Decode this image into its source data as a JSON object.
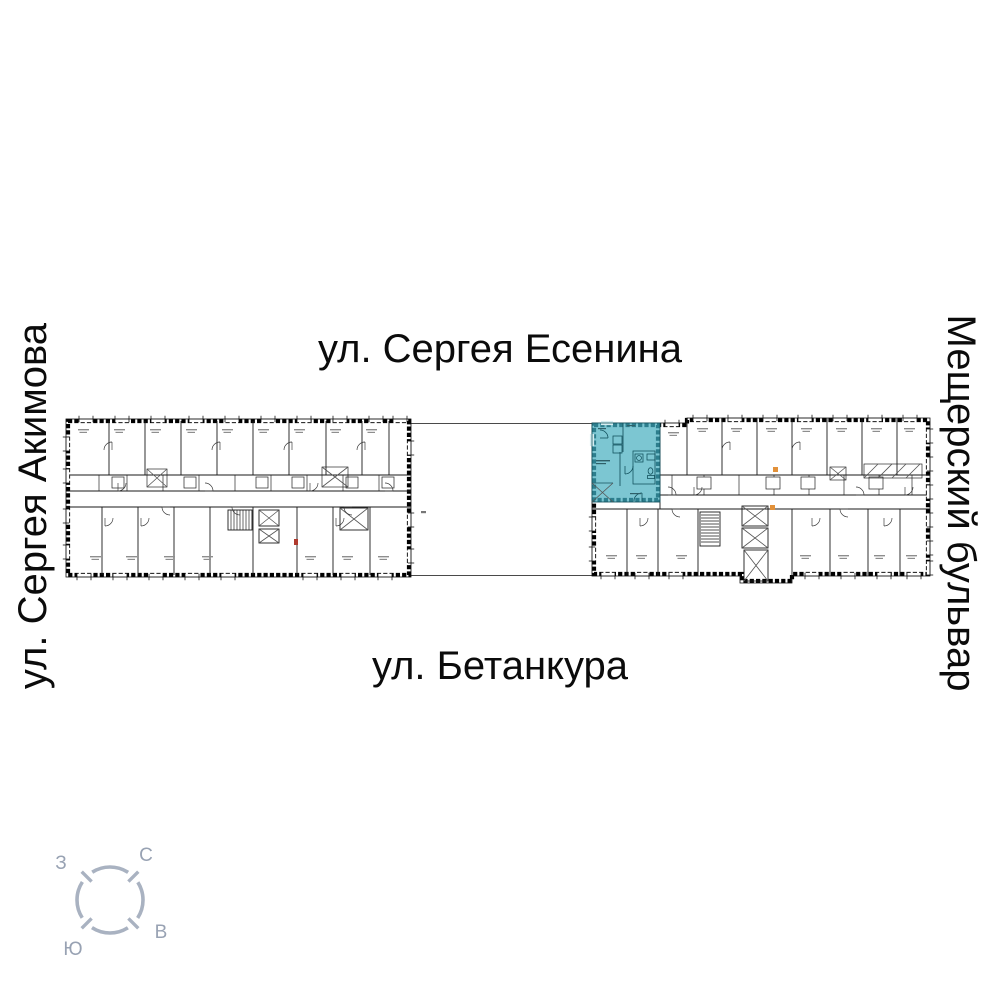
{
  "streets": {
    "top": "ул. Сергея Есенина",
    "bottom": "ул. Бетанкура",
    "left": "ул. Сергея Акимова",
    "right": "Мещерский бульвар"
  },
  "compass": {
    "north": "С",
    "east": "В",
    "south": "Ю",
    "west": "З"
  },
  "colors": {
    "highlight_fill": "#7cc6d2",
    "highlight_wall": "#2d7e8d",
    "wall": "#000000",
    "plan_line": "#1a1a1a",
    "label_mark": "#8e8e8e",
    "entry_red": "#b03a2e",
    "utility_orange": "#e2913a",
    "compass_stroke": "#a9b2c1",
    "compass_text": "#98a2b3"
  }
}
